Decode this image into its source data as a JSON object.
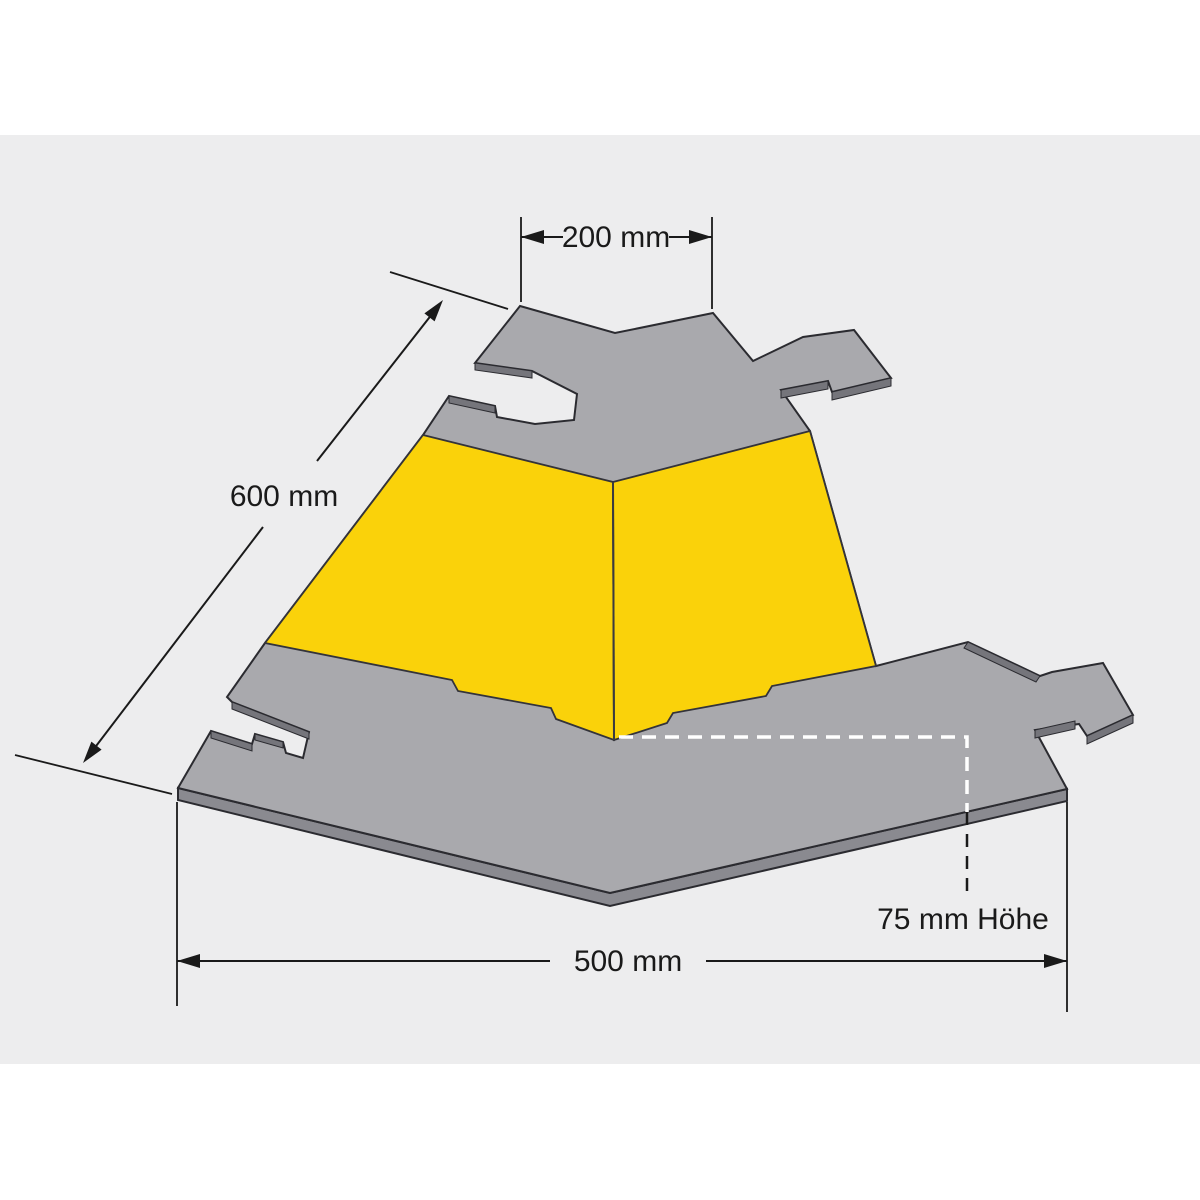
{
  "diagram": {
    "kind": "technical dimension drawing",
    "subject": "cable protector corner section, top view",
    "labels": {
      "top_width": "200 mm",
      "side_length": "600 mm",
      "bottom_width": "500 mm",
      "height": "75 mm Höhe"
    }
  },
  "colors": {
    "page": "#ffffff",
    "canvas": "#ededee",
    "body_gray": "#a9a9ad",
    "edge_band": "#8a8a90",
    "cut_face": "#75757b",
    "ramp_yellow": "#fad20a",
    "line": "#1a1a1a"
  }
}
